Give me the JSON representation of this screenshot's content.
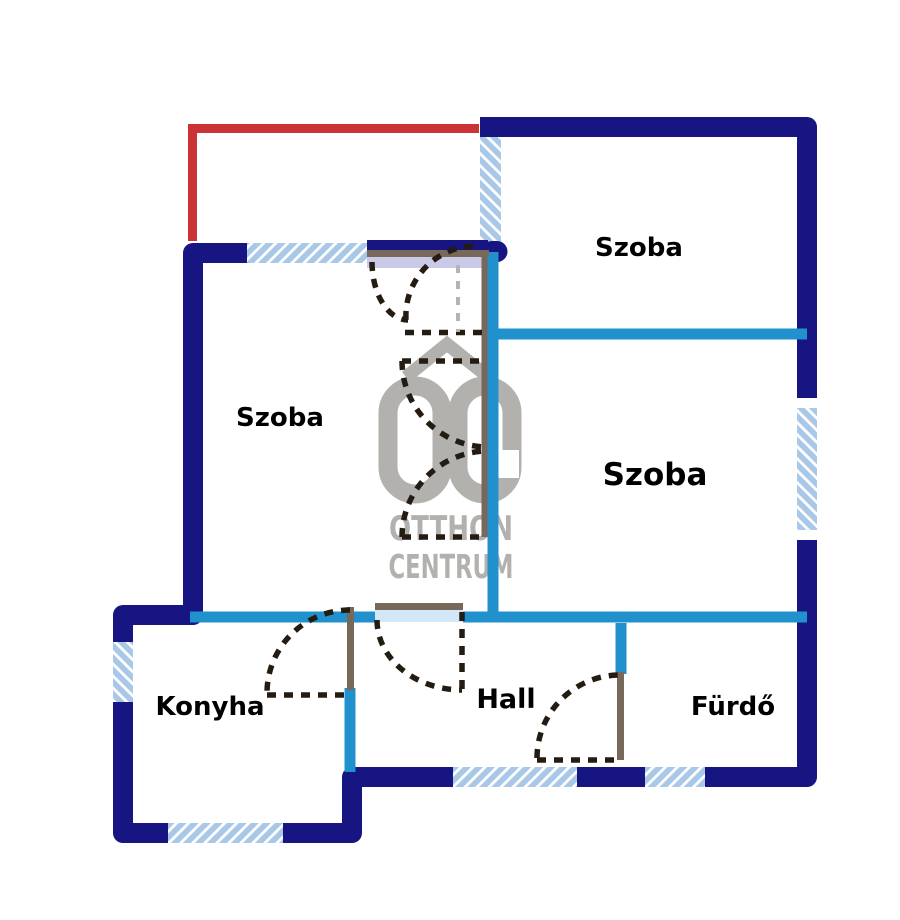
{
  "page": {
    "background": "#ffffff",
    "type": "floor-plan"
  },
  "rooms": {
    "szoba_top": {
      "label": "Szoba"
    },
    "szoba_left": {
      "label": "Szoba"
    },
    "szoba_right": {
      "label": "Szoba"
    },
    "konyha": {
      "label": "Konyha"
    },
    "hall": {
      "label": "Hall"
    },
    "furdo": {
      "label": "Fürdő"
    }
  },
  "watermark": {
    "monogram": "OC",
    "line1": "OTTHON",
    "line2": "CENTRUM",
    "color": "#b3b1ae"
  },
  "colors": {
    "exterior_wall": "#171582",
    "interior_wall": "#2191ce",
    "window_fill": "#a9c7e6",
    "window_stripe": "#ffffff",
    "balcony_line": "#cc3336",
    "door_frame": "#77685a",
    "door_swing_dash": "#241c12",
    "door_swing_dash_gray": "#b4b4b4",
    "door_slide_fill": "#c9c9e8",
    "door_opening_fill": "#d4e7f6",
    "label_color": "#000000"
  }
}
